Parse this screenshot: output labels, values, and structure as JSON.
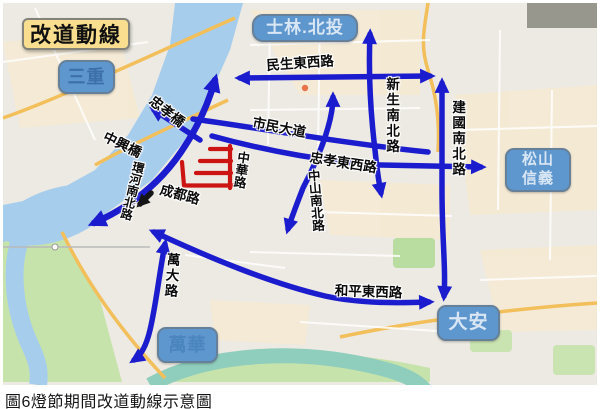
{
  "title": {
    "text": "改道動線"
  },
  "caption": {
    "text": "圖6燈節期間改道動線示意圖"
  },
  "areas": {
    "sanchong": "三重",
    "shilin_beitou": "士林.北投",
    "songshan_xinyi": "松山信義",
    "daan": "大安",
    "wanhua": "萬華"
  },
  "roads": {
    "minsheng": "民生東西路",
    "xinsheng": "新生南北路",
    "jianguo": "建國南北路",
    "zhongshan": "中山南北路",
    "zhongxiao_rd": "忠孝東西路",
    "shimin": "市民大道",
    "zhongxiao_bridge": "忠孝橋",
    "zhongxing_bridge": "中興橋",
    "huanhe": "環河南北路",
    "zhonghua": "中華路",
    "chengdu": "成都路",
    "wanda": "萬大路",
    "heping": "和平東西路"
  },
  "colors": {
    "route_blue": "#1b1ccd",
    "restricted_red": "#cc1512",
    "direction_black": "#151515",
    "area_box_fill": "#5e96ce",
    "title_fill": "#f8de8e",
    "water_blue": "#a7cded"
  }
}
